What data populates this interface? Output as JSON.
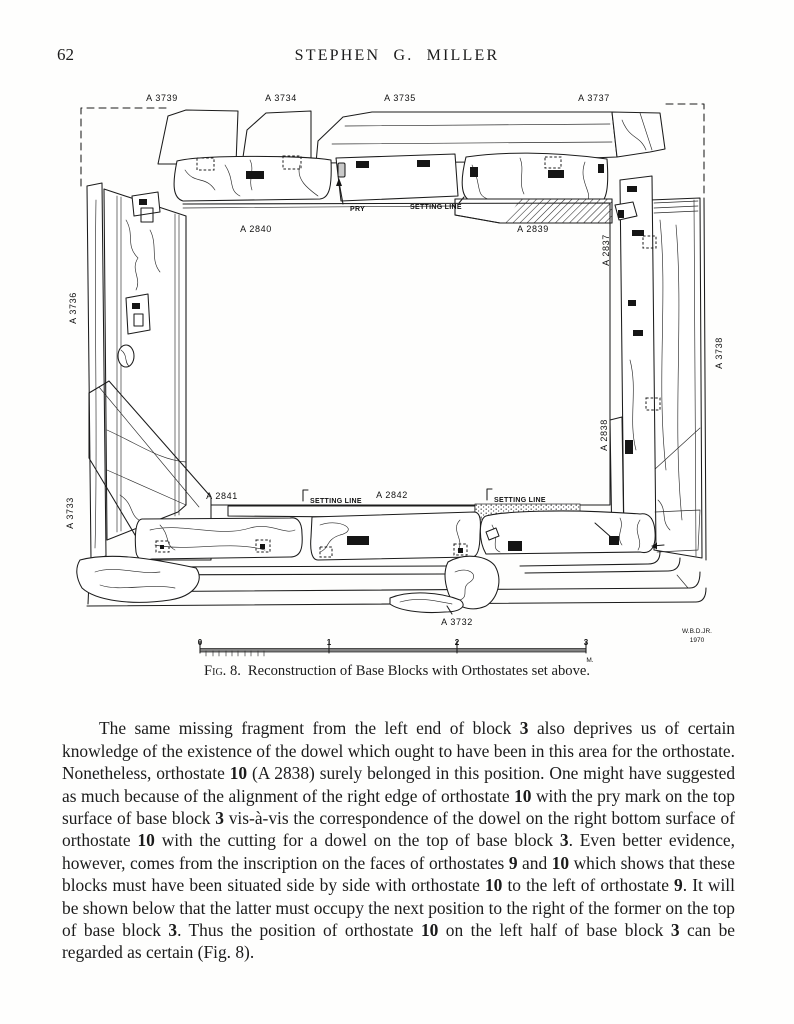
{
  "page": {
    "number": "62",
    "running_title": "STEPHEN G. MILLER"
  },
  "figure": {
    "caption": {
      "label": "Fig. 8.",
      "text": "Reconstruction of Base Blocks with Orthostates set above."
    },
    "labels": {
      "a3739": "A 3739",
      "a3734": "A 3734",
      "a3735": "A 3735",
      "a3737": "A 3737",
      "a3736": "A 3736",
      "a3733": "A 3733",
      "a3738": "A 3738",
      "a3732": "A 3732",
      "a2840": "A 2840",
      "a2839": "A 2839",
      "a2837": "A 2837",
      "a2838": "A 2838",
      "a2841": "A 2841",
      "a2842": "A 2842"
    },
    "annotations": {
      "pry": "PRY",
      "setting_line": "SETTING LINE"
    },
    "scale": {
      "ticks": [
        "0",
        "1",
        "2",
        "3"
      ],
      "unit": "M."
    },
    "credit": {
      "name": "W.B.D.JR.",
      "year": "1970"
    }
  },
  "body": {
    "paragraph_segments": [
      {
        "text": "The same missing fragment from the left end of block ",
        "bold": false
      },
      {
        "text": "3",
        "bold": true
      },
      {
        "text": " also deprives us of certain knowledge of the existence of the dowel which ought to have been in this area for the orthostate. Nonetheless, orthostate ",
        "bold": false
      },
      {
        "text": "10",
        "bold": true
      },
      {
        "text": " (A 2838) surely belonged in this position. One might have suggested as much because of the alignment of the right edge of orthostate ",
        "bold": false
      },
      {
        "text": "10",
        "bold": true
      },
      {
        "text": " with the pry mark on the top surface of base block ",
        "bold": false
      },
      {
        "text": "3",
        "bold": true
      },
      {
        "text": " vis-à-vis the correspondence of the dowel on the right bottom surface of orthostate ",
        "bold": false
      },
      {
        "text": "10",
        "bold": true
      },
      {
        "text": " with the cutting for a dowel on the top of base block ",
        "bold": false
      },
      {
        "text": "3",
        "bold": true
      },
      {
        "text": ". Even better evidence, however, comes from the inscription on the faces of orthostates ",
        "bold": false
      },
      {
        "text": "9",
        "bold": true
      },
      {
        "text": " and ",
        "bold": false
      },
      {
        "text": "10",
        "bold": true
      },
      {
        "text": " which shows that these blocks must have been situated side by side with orthostate ",
        "bold": false
      },
      {
        "text": "10",
        "bold": true
      },
      {
        "text": " to the left of orthostate ",
        "bold": false
      },
      {
        "text": "9",
        "bold": true
      },
      {
        "text": ". It will be shown below that the latter must occupy the next position to the right of the former on the top of base block ",
        "bold": false
      },
      {
        "text": "3",
        "bold": true
      },
      {
        "text": ". Thus the position of orthostate ",
        "bold": false
      },
      {
        "text": "10",
        "bold": true
      },
      {
        "text": " on the left half of base block ",
        "bold": false
      },
      {
        "text": "3",
        "bold": true
      },
      {
        "text": " can be regarded as certain (Fig. 8).",
        "bold": false
      }
    ]
  }
}
